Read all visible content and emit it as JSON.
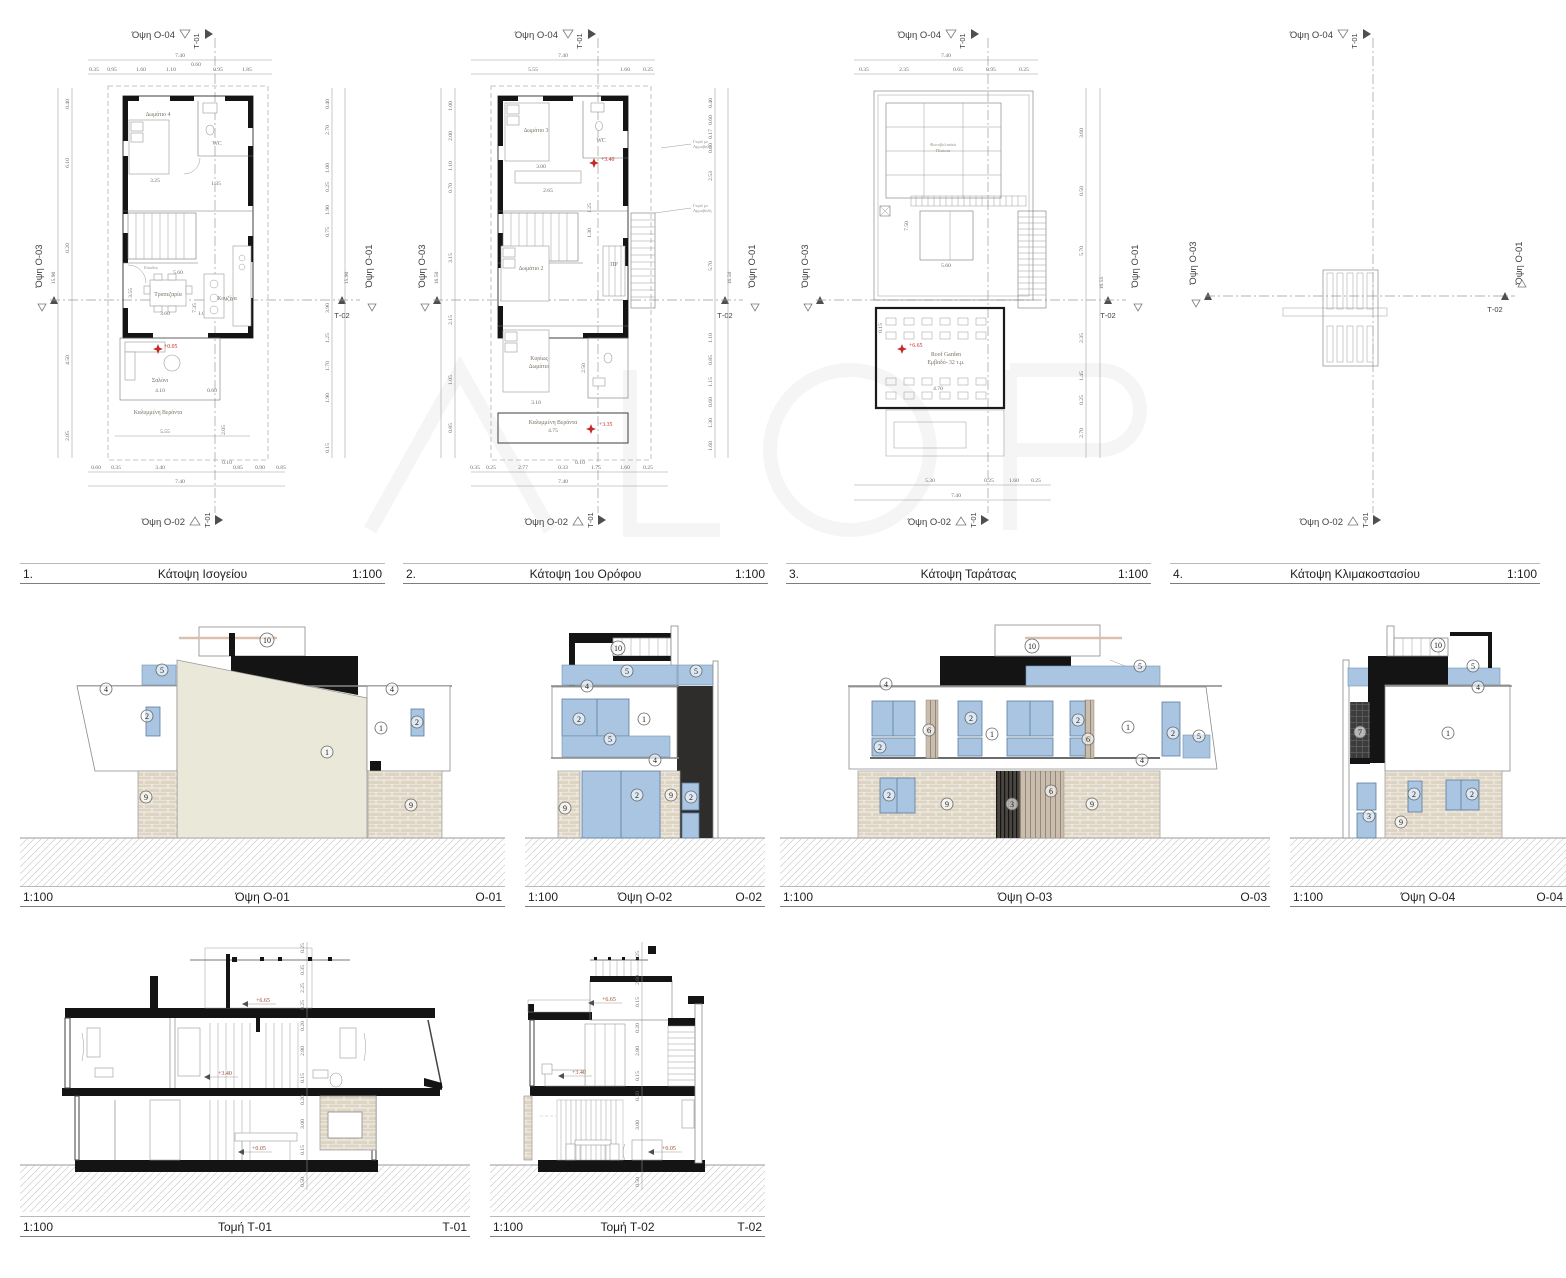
{
  "edges": {
    "top": "Όψη Ο-04",
    "bottom": "Όψη Ο-02",
    "left": "Όψη Ο-03",
    "right": "Όψη Ο-01",
    "t01": "Τ-01",
    "t02": "Τ-02"
  },
  "plans": [
    {
      "num": "1.",
      "title": "Κάτοψη Ισογείου",
      "scale": "1:100",
      "level": "+0.05",
      "rooms": {
        "r1": "Δωμάτιο 4",
        "r2": "WC",
        "r3": "Είσοδος",
        "r4": "Τραπεζαρία",
        "r5": "Κουζίνα",
        "r6": "Σαλόνι",
        "r7": "Καλυμμένη Βεράντα"
      },
      "dims": {
        "w": "7.40",
        "t60": "0.60",
        "t": [
          "0.35",
          "0.95",
          "1.60",
          "1.10",
          "0.95",
          "1.85"
        ],
        "b10": "0.10",
        "b": [
          "0.60",
          "0.35",
          "3.40",
          "0.85",
          "0.90",
          "0.85"
        ],
        "l": [
          "0.40",
          "6.10",
          "0.20",
          "4.50",
          "2.05"
        ],
        "ltot": "15.90",
        "r": [
          "0.40",
          "2.70",
          "1.00",
          "0.25",
          "1.90",
          "0.75",
          "3.90",
          "1.25",
          "1.70",
          "1.90",
          "0.15"
        ],
        "rtot": "15.90",
        "i": [
          "3.25",
          "1.35",
          "5.60",
          "3.55",
          "3.60",
          "1.00",
          "7.35",
          "4.10",
          "0.60",
          "5.55",
          "2.05"
        ]
      }
    },
    {
      "num": "2.",
      "title": "Κάτοψη 1ου Ορόφου",
      "scale": "1:100",
      "level_a": "+3.40",
      "level_b": "+3.35",
      "note1": "Γκριλ με",
      "note2": "Αμμοβολή",
      "rooms": {
        "r1": "Δωμάτιο 3",
        "r2": "WC",
        "r3": "Δωμάτιο 2",
        "r4": "ΠΡ",
        "r5a": "Κυρίως",
        "r5b": "Δωμάτιο",
        "r6": "Καλυμμένη Βεράντα"
      },
      "dims": {
        "w": "7.40",
        "t": [
          "5.55",
          "1.60",
          "0.25"
        ],
        "b": [
          "0.35",
          "0.25",
          "2.77",
          "0.33",
          "0.10",
          "1.75",
          "1.60",
          "0.25"
        ],
        "l": [
          "1.00",
          "2.00",
          "1.10",
          "0.70",
          "3.15",
          "2.15",
          "1.05",
          "0.85"
        ],
        "ltot": "16.50",
        "r": [
          "0.40",
          "0.60",
          "0.17",
          "0.60",
          "2.53",
          "5.70",
          "1.10",
          "0.85",
          "1.15",
          "0.60",
          "1.30",
          "1.60"
        ],
        "rtot": "16.50",
        "i": [
          "3.00",
          "2.65",
          "1.25",
          "1.30",
          "3.10",
          "2.50",
          "4.75",
          "0.90"
        ]
      }
    },
    {
      "num": "3.",
      "title": "Κάτοψη Ταράτσας",
      "scale": "1:100",
      "level": "+6.65",
      "rooms": {
        "r1a": "Φωτοβολταϊκά",
        "r1b": "Πλαίσια",
        "r2a": "Roof Garden",
        "r2b": "Εμβαδό- 32 τ.μ."
      },
      "dims": {
        "w": "7.40",
        "t": [
          "0.35",
          "2.35",
          "0.65",
          "0.95",
          "0.25"
        ],
        "b": [
          "5.30",
          "0.25",
          "1.60",
          "0.25"
        ],
        "r": [
          "3.60",
          "0.50",
          "5.70",
          "2.35",
          "1.45",
          "0.25",
          "2.70"
        ],
        "rtot": "16.55",
        "i": [
          "7.50",
          "5.60",
          "4.70",
          "0.15",
          "5.70"
        ]
      }
    },
    {
      "num": "4.",
      "title": "Κάτοψη Κλιμακοστασίου",
      "scale": "1:100"
    }
  ],
  "elevations": [
    {
      "scale": "1:100",
      "title": "Όψη Ο-01",
      "code": "Ο-01",
      "c": [
        "10",
        "5",
        "4",
        "2",
        "1",
        "4",
        "2",
        "1",
        "9",
        "9"
      ]
    },
    {
      "scale": "1:100",
      "title": "Όψη Ο-02",
      "code": "Ο-02",
      "c": [
        "10",
        "5",
        "5",
        "4",
        "2",
        "1",
        "5",
        "4",
        "9",
        "2",
        "9",
        "2"
      ]
    },
    {
      "scale": "1:100",
      "title": "Όψη Ο-03",
      "code": "Ο-03",
      "c": [
        "10",
        "5",
        "4",
        "2",
        "6",
        "2",
        "1",
        "2",
        "6",
        "1",
        "2",
        "5",
        "4",
        "2",
        "9",
        "3",
        "6",
        "9"
      ]
    },
    {
      "scale": "1:100",
      "title": "Όψη Ο-04",
      "code": "Ο-04",
      "c": [
        "10",
        "5",
        "4",
        "7",
        "1",
        "2",
        "2",
        "3",
        "9"
      ]
    }
  ],
  "sections": [
    {
      "scale": "1:100",
      "title": "Τομή Τ-01",
      "code": "Τ-01",
      "levels": [
        "+6.65",
        "+3.40",
        "+0.05"
      ],
      "dims": [
        "0.25",
        "0.35",
        "2.25",
        "0.25",
        "0.20",
        "2.80",
        "0.15",
        "0.20",
        "3.00",
        "0.15",
        "0.50"
      ]
    },
    {
      "scale": "1:100",
      "title": "Τομή Τ-02",
      "code": "Τ-02",
      "levels": [
        "+6.65",
        "+3.40",
        "+0.05"
      ],
      "dims": [
        "0.25",
        "2.60",
        "0.15",
        "0.20",
        "2.80",
        "0.15",
        "0.20",
        "3.00",
        "0.50"
      ]
    }
  ],
  "colors": {
    "window_blue": "#a9c5e1",
    "wall_beige": "#e9e8d9",
    "stone_tan": "#ddd4c4",
    "accent_red": "#c62828"
  }
}
